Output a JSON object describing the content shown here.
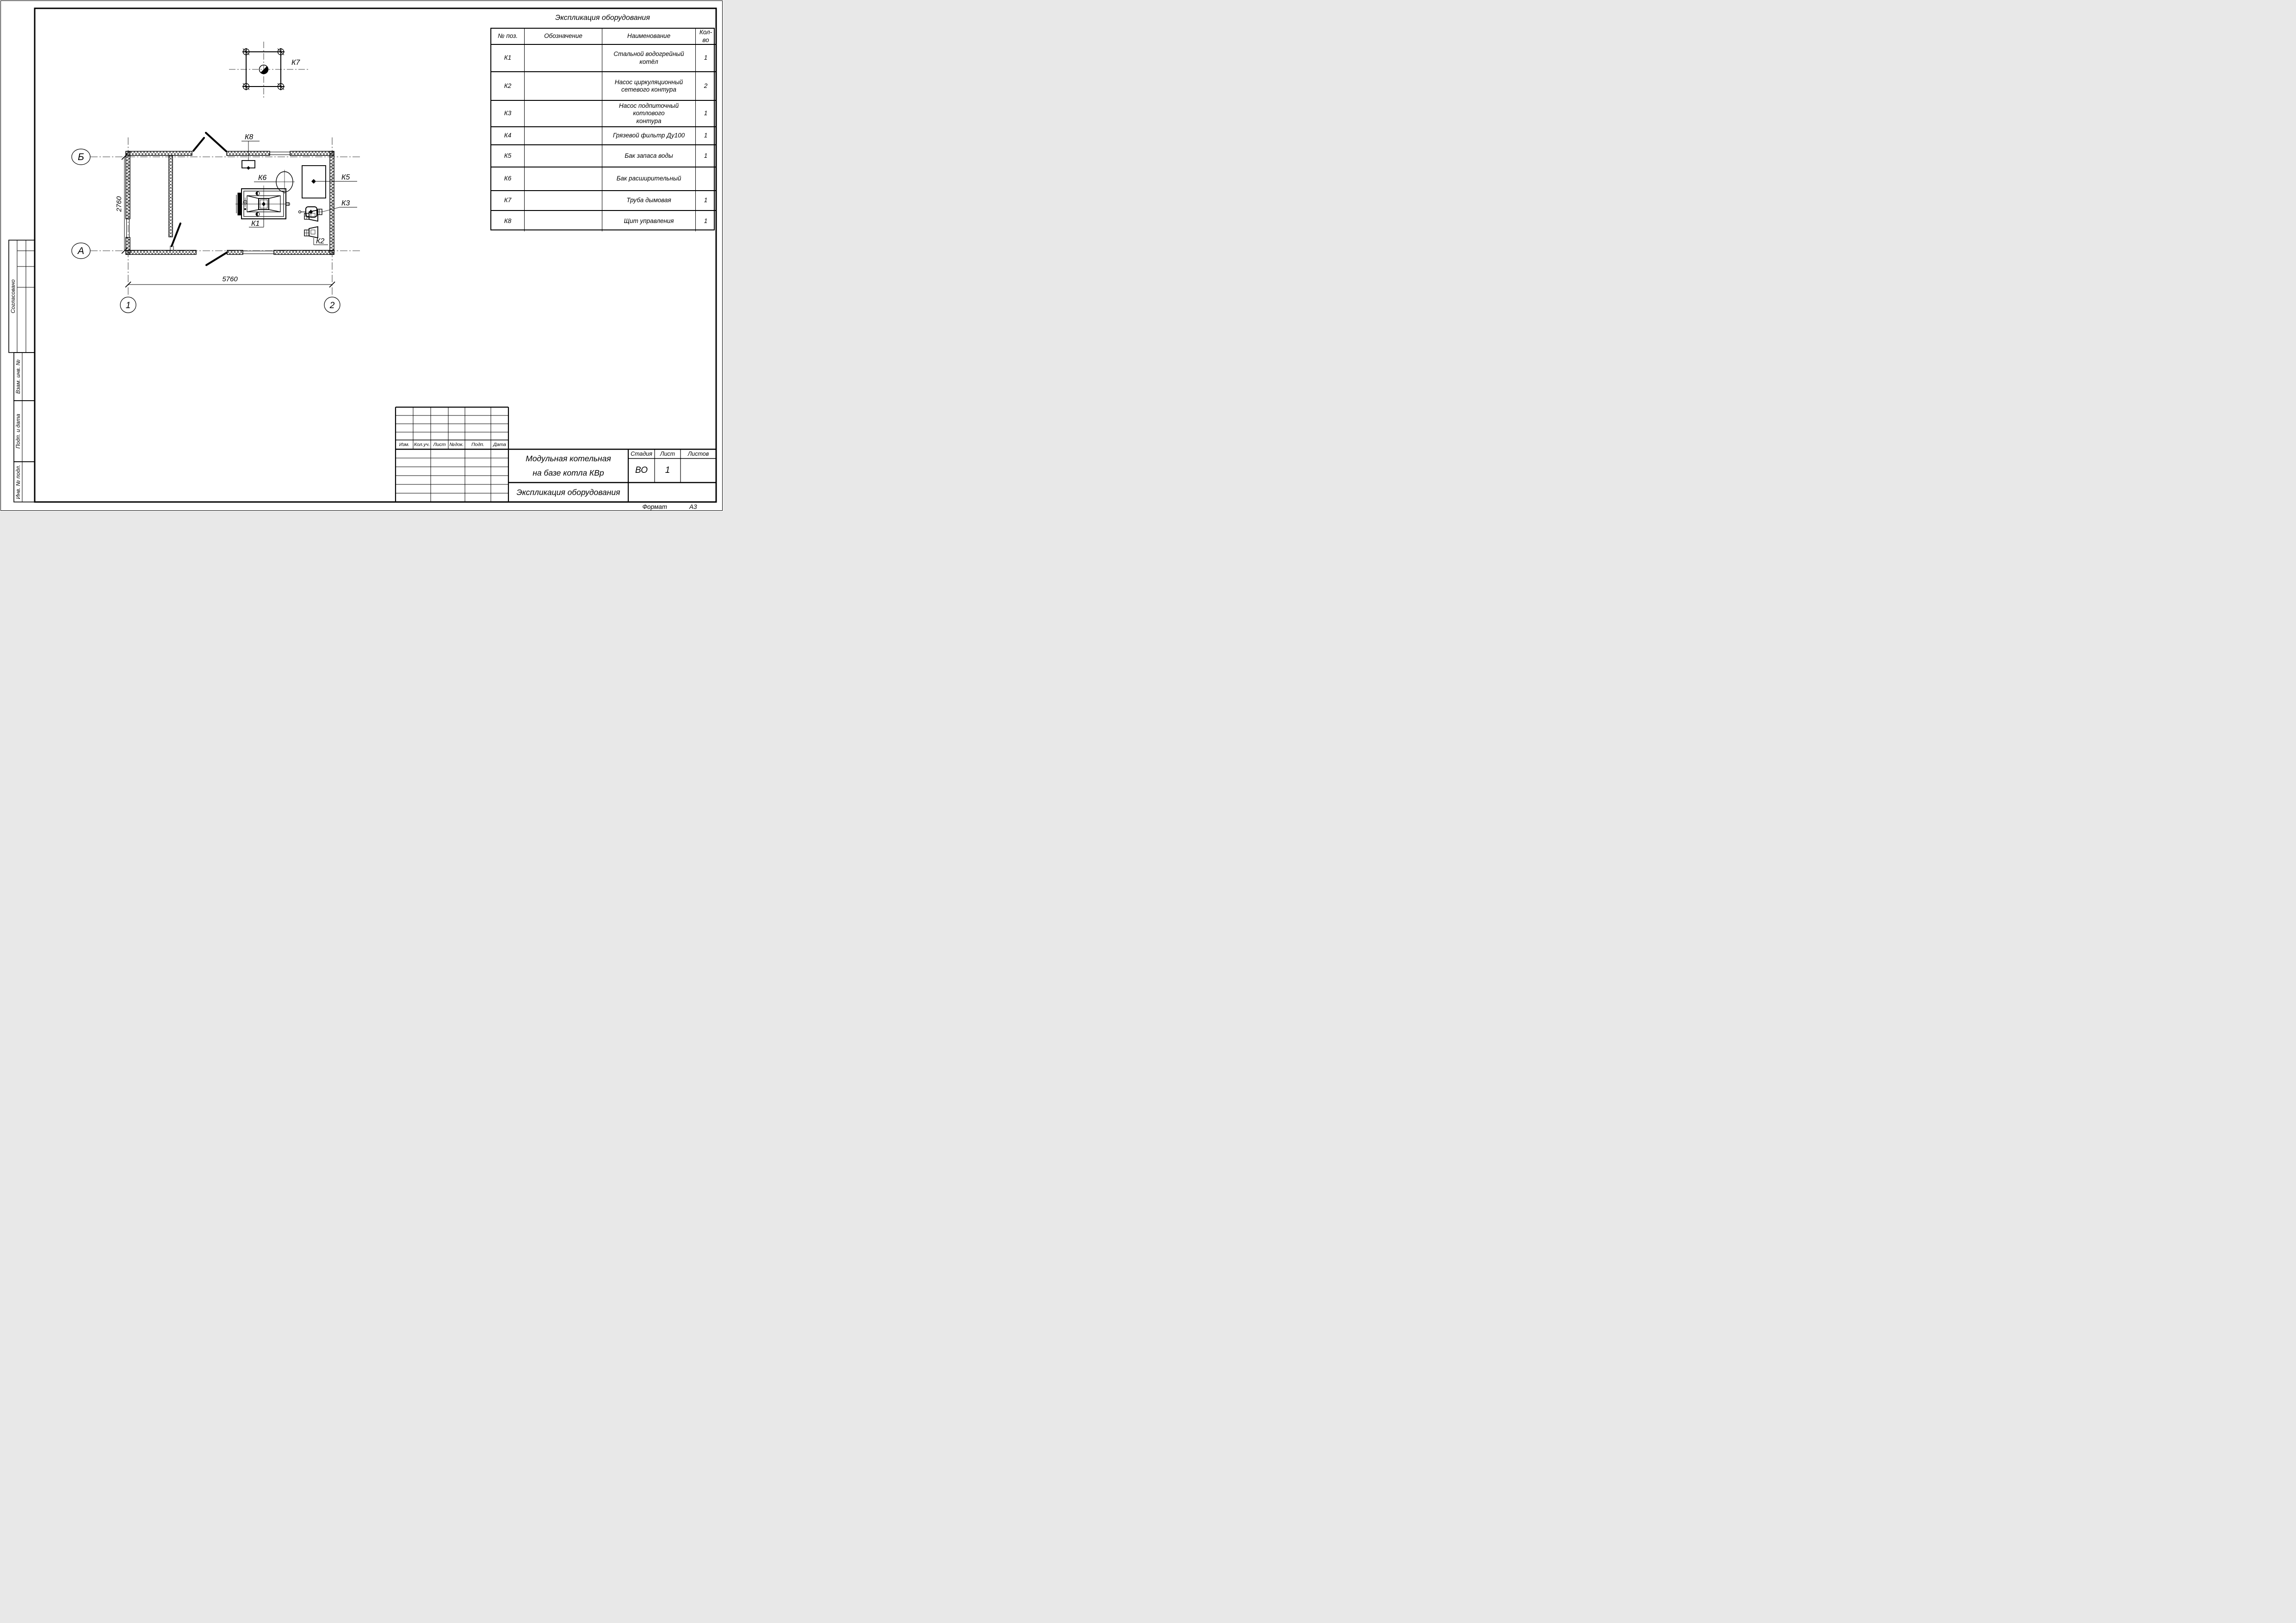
{
  "sheet": {
    "format_label": "Формат",
    "format_value": "А3"
  },
  "plan": {
    "axes": {
      "b": "Б",
      "a": "А",
      "one": "1",
      "two": "2"
    },
    "dim_width": "5760",
    "dim_height": "2760",
    "tags": {
      "k1": "К1",
      "k2": "К2",
      "k3": "К3",
      "k5": "К5",
      "k6": "К6",
      "k7": "К7",
      "k8": "К8"
    }
  },
  "equipment_table": {
    "title": "Экспликация оборудования",
    "columns": {
      "pos": "№ поз.",
      "designation": "Обозначение",
      "name": "Наименование",
      "qty": "Кол-во"
    },
    "rows": [
      {
        "pos": "К1",
        "designation": "",
        "name": "Стальной водогрейный котёл",
        "qty": "1"
      },
      {
        "pos": "К2",
        "designation": "",
        "name": "Насос циркуляционный\nсетевого контура",
        "qty": "2"
      },
      {
        "pos": "К3",
        "designation": "",
        "name": "Насос подпиточный котлового\nконтура",
        "qty": "1"
      },
      {
        "pos": "К4",
        "designation": "",
        "name": "Грязевой фильтр Ду100",
        "qty": "1"
      },
      {
        "pos": "К5",
        "designation": "",
        "name": "Бак запаса воды",
        "qty": "1"
      },
      {
        "pos": "К6",
        "designation": "",
        "name": "Бак расширительный",
        "qty": ""
      },
      {
        "pos": "К7",
        "designation": "",
        "name": "Труба дымовая",
        "qty": "1"
      },
      {
        "pos": "К8",
        "designation": "",
        "name": "Щит управления",
        "qty": "1"
      }
    ]
  },
  "title_block": {
    "revision_columns": [
      "Изм.",
      "Кол.уч.",
      "Лист",
      "№док.",
      "Подп.",
      "Дата"
    ],
    "project_title_line1": "Модульная котельная",
    "project_title_line2": "на базе котла КВр",
    "sheet_title": "Экспликация оборудования",
    "stage_label": "Стадия",
    "stage_value": "ВО",
    "sheet_label": "Лист",
    "sheet_value": "1",
    "sheets_label": "Листов",
    "sheets_value": ""
  },
  "side_stamp": {
    "agreed": "Согласовано",
    "replaced_inv": "Взам. инв. №",
    "sign_and_date": "Подп. и дата",
    "inv_original": "Инв. № подл."
  }
}
